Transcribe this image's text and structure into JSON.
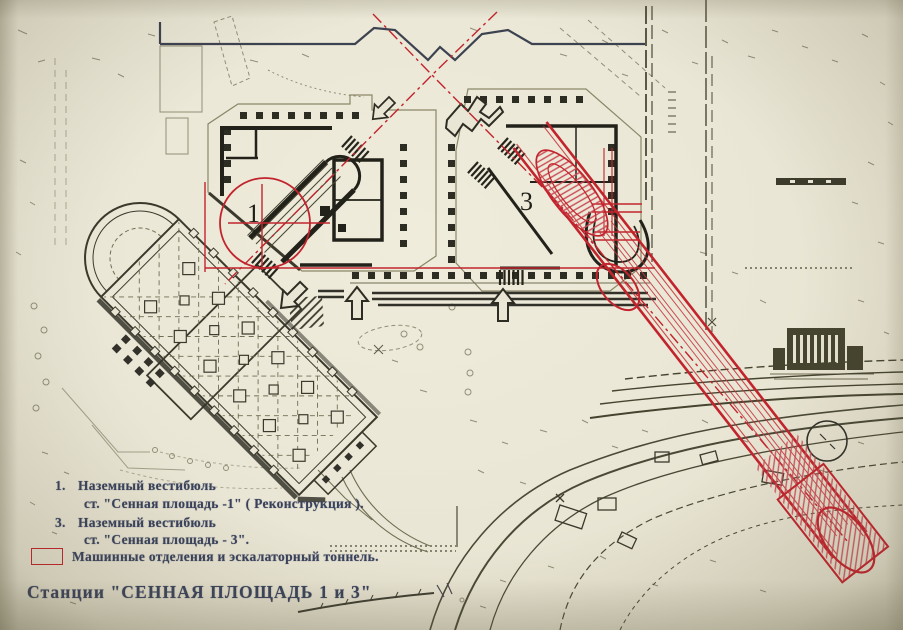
{
  "title": "Станции \"СЕННАЯ ПЛОЩАДЬ  1 и 3\"",
  "legend": {
    "item1": {
      "num": "1.",
      "line1": "Наземный вестибюль",
      "line2": "ст. \"Сенная площадь -1\" ( Реконструкция )."
    },
    "item3": {
      "num": "3.",
      "line1": "Наземный вестибюль",
      "line2": "ст. \"Сенная площадь - 3\"."
    },
    "tunnel": {
      "label": "Машинные отделения и эскалаторный тоннель."
    }
  },
  "plan_labels": {
    "vestibule1": "1",
    "vestibule3": "3"
  },
  "colors": {
    "paper": "#eae6d5",
    "ink": "#3a392c",
    "light_ink": "#6f6d52",
    "overlay_red": "#c2242d",
    "legend_text": "#39425c"
  }
}
